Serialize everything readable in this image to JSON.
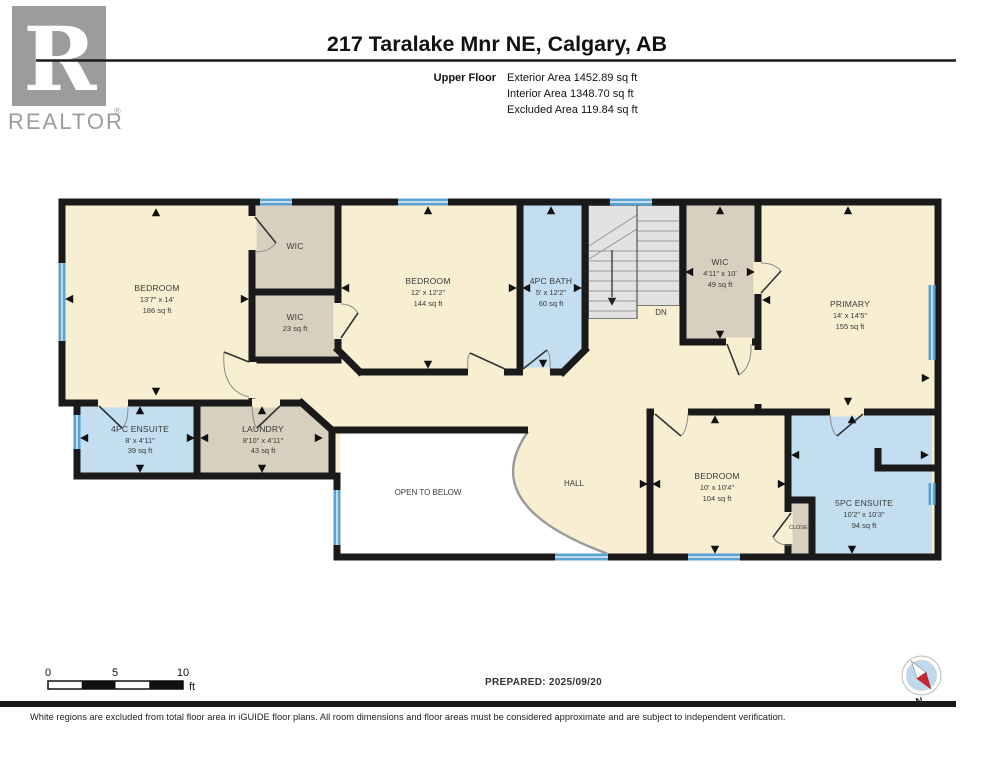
{
  "header": {
    "title": "217 Taralake Mnr NE, Calgary, AB",
    "floor_label": "Upper Floor",
    "area_lines": [
      "Exterior Area 1452.89 sq ft",
      "Interior Area 1348.70 sq ft",
      "Excluded Area 119.84 sq ft"
    ]
  },
  "branding": {
    "logo_letter": "R",
    "logo_text": "REALTOR",
    "logo_reg": "®"
  },
  "rooms": {
    "bedroom_left": {
      "name": "BEDROOM",
      "dims": "13'7\" x 14'",
      "area": "186 sq ft"
    },
    "wic_top": {
      "name": "WIC"
    },
    "wic_small": {
      "name": "WIC",
      "area": "23 sq ft"
    },
    "bedroom_mid": {
      "name": "BEDROOM",
      "dims": "12' x 12'2\"",
      "area": "144 sq ft"
    },
    "bath": {
      "name": "4PC BATH",
      "dims": "5' x 12'2\"",
      "area": "60 sq ft"
    },
    "stairs": {
      "label": "DN"
    },
    "wic_right": {
      "name": "WIC",
      "dims": "4'11\" x 10'",
      "area": "49 sq ft"
    },
    "primary": {
      "name": "PRIMARY",
      "dims": "14' x 14'5\"",
      "area": "155 sq ft"
    },
    "ensuite4": {
      "name": "4PC ENSUITE",
      "dims": "8' x 4'11\"",
      "area": "39 sq ft"
    },
    "laundry": {
      "name": "LAUNDRY",
      "dims": "8'10\" x 4'11\"",
      "area": "43 sq ft"
    },
    "open_below": {
      "name": "OPEN TO BELOW"
    },
    "hall": {
      "name": "HALL"
    },
    "bedroom_br": {
      "name": "BEDROOM",
      "dims": "10' x 10'4\"",
      "area": "104 sq ft"
    },
    "closet": {
      "name": "CLOSET"
    },
    "ensuite5": {
      "name": "5PC ENSUITE",
      "dims": "10'2\" x 10'3\"",
      "area": "94 sq ft"
    }
  },
  "footer": {
    "scale": {
      "t0": "0",
      "t5": "5",
      "t10": "10",
      "unit": "ft"
    },
    "prepared": "PREPARED: 2025/09/20",
    "compass": "N",
    "disclaimer": "White regions are excluded from total floor area in iGUIDE floor plans. All room dimensions and floor areas must be considered approximate and are subject to independent verification."
  },
  "colors": {
    "wall": "#1A1A1A",
    "floor_cream": "#F8EFD3",
    "closet_tan": "#D8D0BF",
    "bath_blue": "#C3DEF1",
    "window_blue": "#5CA2D1",
    "stairs_gray": "#E2E2E2",
    "excluded_white": "#FFFFFF",
    "compass_red": "#C9252C",
    "logo_gray": "#9C9C9C"
  }
}
